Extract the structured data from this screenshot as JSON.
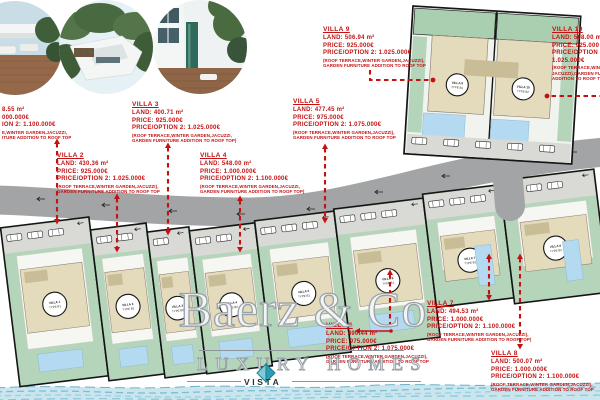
{
  "watermark": {
    "brand": "Baerz & Co",
    "tagline": "LUXURY HOMES",
    "logo": "VISTA"
  },
  "photos": [
    {
      "name": "rooftop terrace photo"
    },
    {
      "name": "aerial villas photo"
    },
    {
      "name": "villa pool photo"
    }
  ],
  "colors": {
    "annotation_red": "#c41212",
    "road_gray": "#a2a4a6",
    "parking_gray": "#d9d9d6",
    "garden_green": "#b5d5bb",
    "garden_green_dark": "#a9cfb0",
    "building_beige": "#e4dabc",
    "roof_beige": "#c9bd97",
    "pool_blue": "#b4daf2",
    "water_blue": "#c9e6ef",
    "water_stroke": "#7fbcd0",
    "plot_border": "#141414",
    "logo_teal_light": "#7fccd8",
    "logo_teal_dark": "#2e9db4"
  },
  "plots": [
    {
      "label": "VILLA 1",
      "type": "TYPE B1"
    },
    {
      "label": "VILLA 2",
      "type": "TYPE B1"
    },
    {
      "label": "VILLA 3",
      "type": "TYPE B2"
    },
    {
      "label": "VILLA 4",
      "type": "TYPE B2"
    },
    {
      "label": "VILLA 5",
      "type": "TYPE B1"
    },
    {
      "label": "VILLA 6",
      "type": "TYPE B1"
    },
    {
      "label": "VILLA 7",
      "type": "TYPE B1"
    },
    {
      "label": "VILLA 8",
      "type": "TYPE B1"
    },
    {
      "label": "VILLA 9",
      "type": "TYPE B1"
    },
    {
      "label": "VILLA 10",
      "type": "TYPE B2"
    }
  ],
  "annotations": [
    {
      "id": "villa-1",
      "lines": [
        {
          "t": "8.55 m²",
          "k": "v"
        },
        {
          "t": "000.000€",
          "k": "v"
        },
        {
          "t": "ION 2: 1.100.000€",
          "k": "v"
        },
        {
          "t": "E,WINTER GARDEN,JACUZZI,",
          "k": "n"
        },
        {
          "t": "ITURE ADDITION TO ROOF TOP",
          "k": "n"
        }
      ]
    },
    {
      "id": "villa-2",
      "lines": [
        {
          "t": "VILLA 2",
          "k": "h"
        },
        {
          "t": "LAND: 430.36 m²",
          "k": "v"
        },
        {
          "t": "PRICE: 925.000€",
          "k": "v"
        },
        {
          "t": "PRICE/OPTION 2: 1.025.000€",
          "k": "v"
        },
        {
          "t": "(ROOF TERRACE,WINTER GARDEN,JACUZZI),",
          "k": "n"
        },
        {
          "t": "GARDEN FURNITURE ADDITION TO ROOF TOP",
          "k": "n"
        }
      ]
    },
    {
      "id": "villa-3",
      "lines": [
        {
          "t": "VILLA 3",
          "k": "h"
        },
        {
          "t": "LAND: 400.71 m²",
          "k": "v"
        },
        {
          "t": "PRICE: 925.000€",
          "k": "v"
        },
        {
          "t": "PRICE/OPTION 2: 1.025.000€",
          "k": "v"
        },
        {
          "t": "(ROOF TERRACE,WINTER GARDEN,JACUZZI,",
          "k": "n"
        },
        {
          "t": "GARDEN FURNITURE ADDITION TO ROOF TOP)",
          "k": "n"
        }
      ]
    },
    {
      "id": "villa-4",
      "lines": [
        {
          "t": "VILLA 4",
          "k": "h"
        },
        {
          "t": "LAND: 548.00 m²",
          "k": "v"
        },
        {
          "t": "PRICE: 1.000.000€",
          "k": "v"
        },
        {
          "t": "PRICE/OPTION 2: 1.100.000€",
          "k": "v"
        },
        {
          "t": "(ROOF TERRACE,WINTER GARDEN,JACUZZI,",
          "k": "n"
        },
        {
          "t": "GARDEN FURNITURE ADDITION TO ROOF TOP)",
          "k": "n"
        }
      ]
    },
    {
      "id": "villa-5",
      "lines": [
        {
          "t": "VILLA 5",
          "k": "h"
        },
        {
          "t": "LAND: 477.45 m²",
          "k": "v"
        },
        {
          "t": "PRICE: 975.000€",
          "k": "v"
        },
        {
          "t": "PRICE/OPTION 2: 1.075.000€",
          "k": "v"
        },
        {
          "t": "(ROOF TERRACE,WINTER GARDEN,JACUZZI),",
          "k": "n"
        },
        {
          "t": "GARDEN FURNITURE ADDITION TO ROOF TOP",
          "k": "n"
        }
      ]
    },
    {
      "id": "villa-6",
      "lines": [
        {
          "t": "VILLA 6",
          "k": "h"
        },
        {
          "t": "LAND: 490.44 m²",
          "k": "v"
        },
        {
          "t": "PRICE: 975.000€",
          "k": "v"
        },
        {
          "t": "PRICE/OPTION 2: 1.075.000€",
          "k": "v"
        },
        {
          "t": "(ROOF TERRACE,WINTER GARDEN,JACUZZI),",
          "k": "n"
        },
        {
          "t": "GARDEN FURNITURE ADDITION TO ROOF TOP",
          "k": "n"
        }
      ]
    },
    {
      "id": "villa-7",
      "lines": [
        {
          "t": "VILLA 7",
          "k": "h"
        },
        {
          "t": "LAND: 494.53 m²",
          "k": "v"
        },
        {
          "t": "PRICE: 1.000.000€",
          "k": "v"
        },
        {
          "t": "PRICE/OPTION 2: 1.100.000€",
          "k": "v"
        },
        {
          "t": "(ROOF TERRACE,WINTER GARDEN,JACUZZI),",
          "k": "n"
        },
        {
          "t": "GARDEN FURNITURE ADDITION TO ROOF TOP)",
          "k": "n"
        }
      ]
    },
    {
      "id": "villa-8",
      "lines": [
        {
          "t": "VILLA 8",
          "k": "h"
        },
        {
          "t": "LAND: 500.07 m²",
          "k": "v"
        },
        {
          "t": "PRICE: 1.000.000€",
          "k": "v"
        },
        {
          "t": "PRICE/OPTION 2: 1.100.000€",
          "k": "v"
        },
        {
          "t": "(ROOF TERRACE,WINTER GARDEN,JACUZZI),",
          "k": "n"
        },
        {
          "t": "GARDEN FURNITURE ADDITION TO ROOF TOP",
          "k": "n"
        }
      ]
    },
    {
      "id": "villa-9",
      "lines": [
        {
          "t": "VILLA 9",
          "k": "h"
        },
        {
          "t": "LAND: 506.94 m²",
          "k": "v"
        },
        {
          "t": "PRICE: 925.000€",
          "k": "v"
        },
        {
          "t": "PRICE/OPTION 2: 1.025.000€",
          "k": "v"
        },
        {
          "t": "(ROOF TERRACE,WINTER GARDEN,JACUZZI),",
          "k": "n"
        },
        {
          "t": "GARDEN FURNITURE ADDITION TO ROOF TOP",
          "k": "n"
        }
      ]
    },
    {
      "id": "villa-10",
      "lines": [
        {
          "t": "VILLA 10",
          "k": "h"
        },
        {
          "t": "LAND: 508.00 m",
          "k": "v"
        },
        {
          "t": "PRICE: 925.000",
          "k": "v"
        },
        {
          "t": "PRICE/OPTION 2:",
          "k": "v"
        },
        {
          "t": "1.025.000€",
          "k": "v"
        },
        {
          "t": "(ROOF TERRACE,WINTER",
          "k": "n"
        },
        {
          "t": "JACUZZI),GARDEN FURNI",
          "k": "n"
        },
        {
          "t": "ADDITION TO ROOF TOP",
          "k": "n"
        }
      ]
    }
  ]
}
